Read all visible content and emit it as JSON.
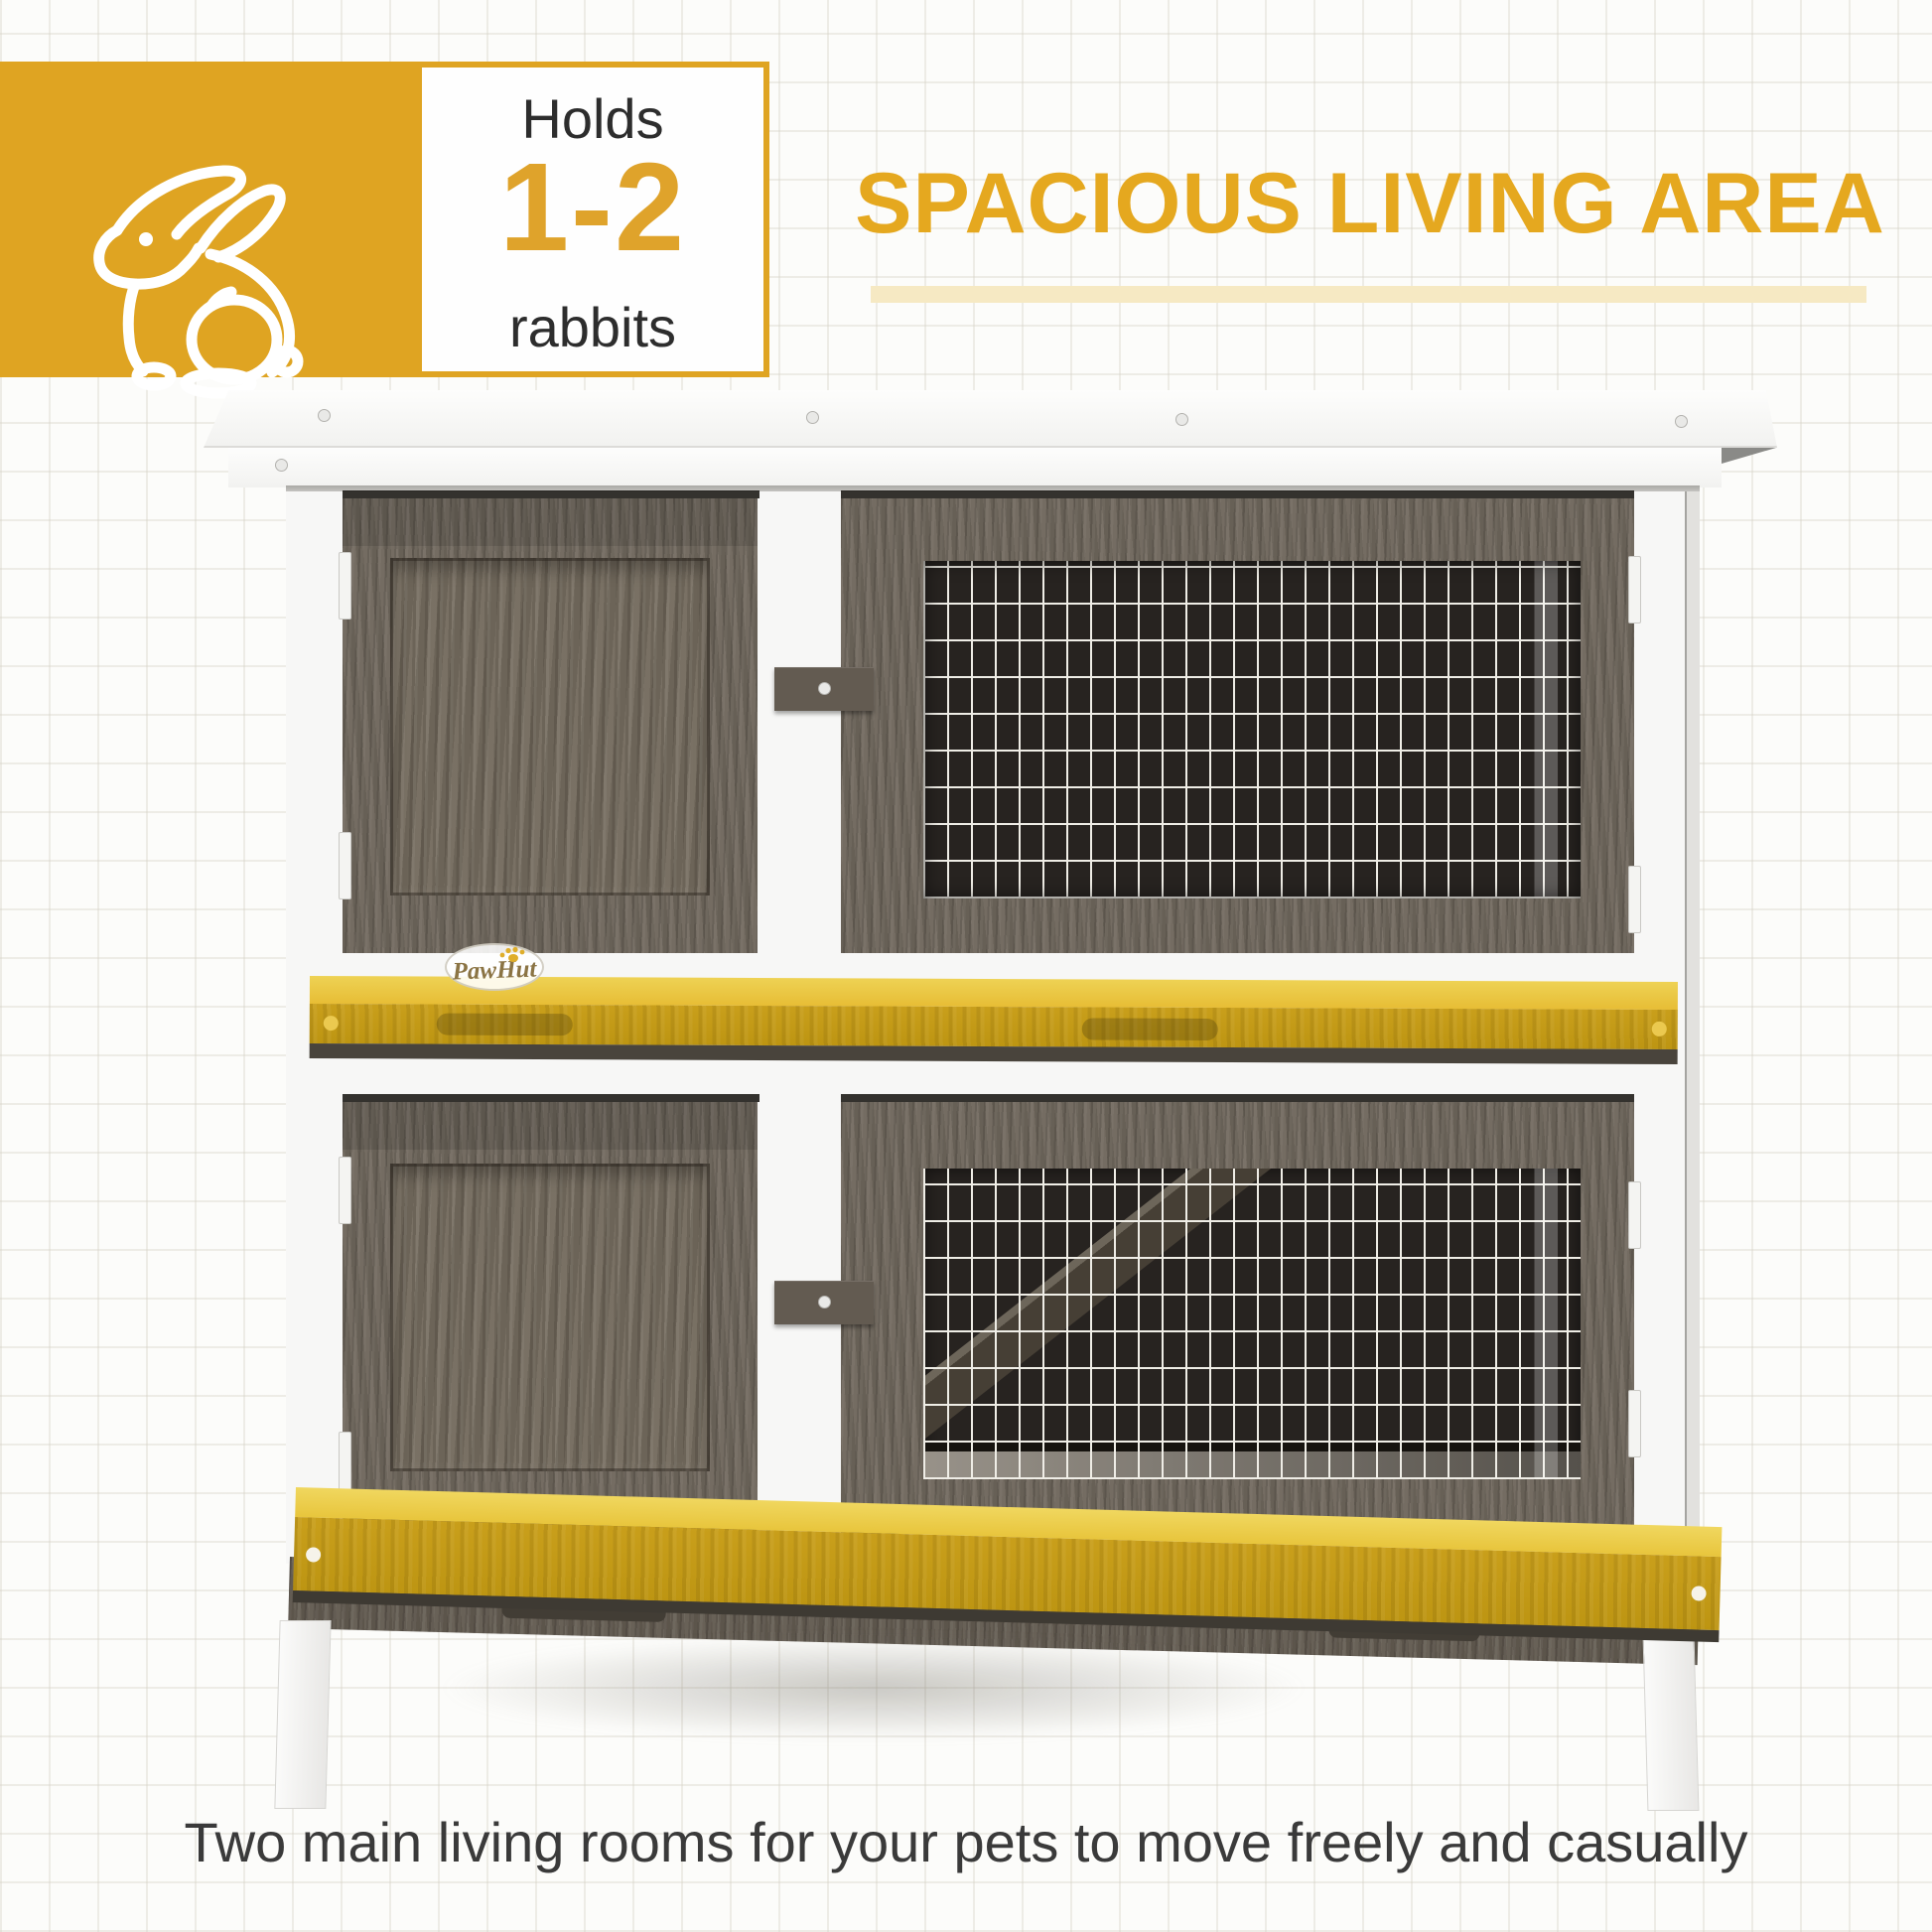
{
  "badge": {
    "holds_label": "Holds",
    "capacity": "1-2",
    "animal_label": "rabbits",
    "icon": "rabbit-outline-icon"
  },
  "heading": {
    "title": "SPACIOUS LIVING AREA"
  },
  "hutch": {
    "brand": "PawHut"
  },
  "caption": {
    "text": "Two main living rooms for your pets to move freely and casually"
  },
  "colors": {
    "accent_yellow": "#DFA422",
    "digits_yellow": "#DFA32B",
    "heading_yellow": "#E5A81F",
    "underline_yellow": "#F6E9C3",
    "tray_yellow_top": "#EED254",
    "tray_yellow_face": "#C99F1B",
    "wood_brown": "#6F675C",
    "wood_dark": "#635B51",
    "mesh_background": "#272320",
    "mesh_wire": "#EFEDE6",
    "white_frame": "#F7F7F6",
    "text_dark": "#2D2D2D",
    "caption_gray": "#3A3A3A",
    "brand_gold": "#8B7444"
  }
}
